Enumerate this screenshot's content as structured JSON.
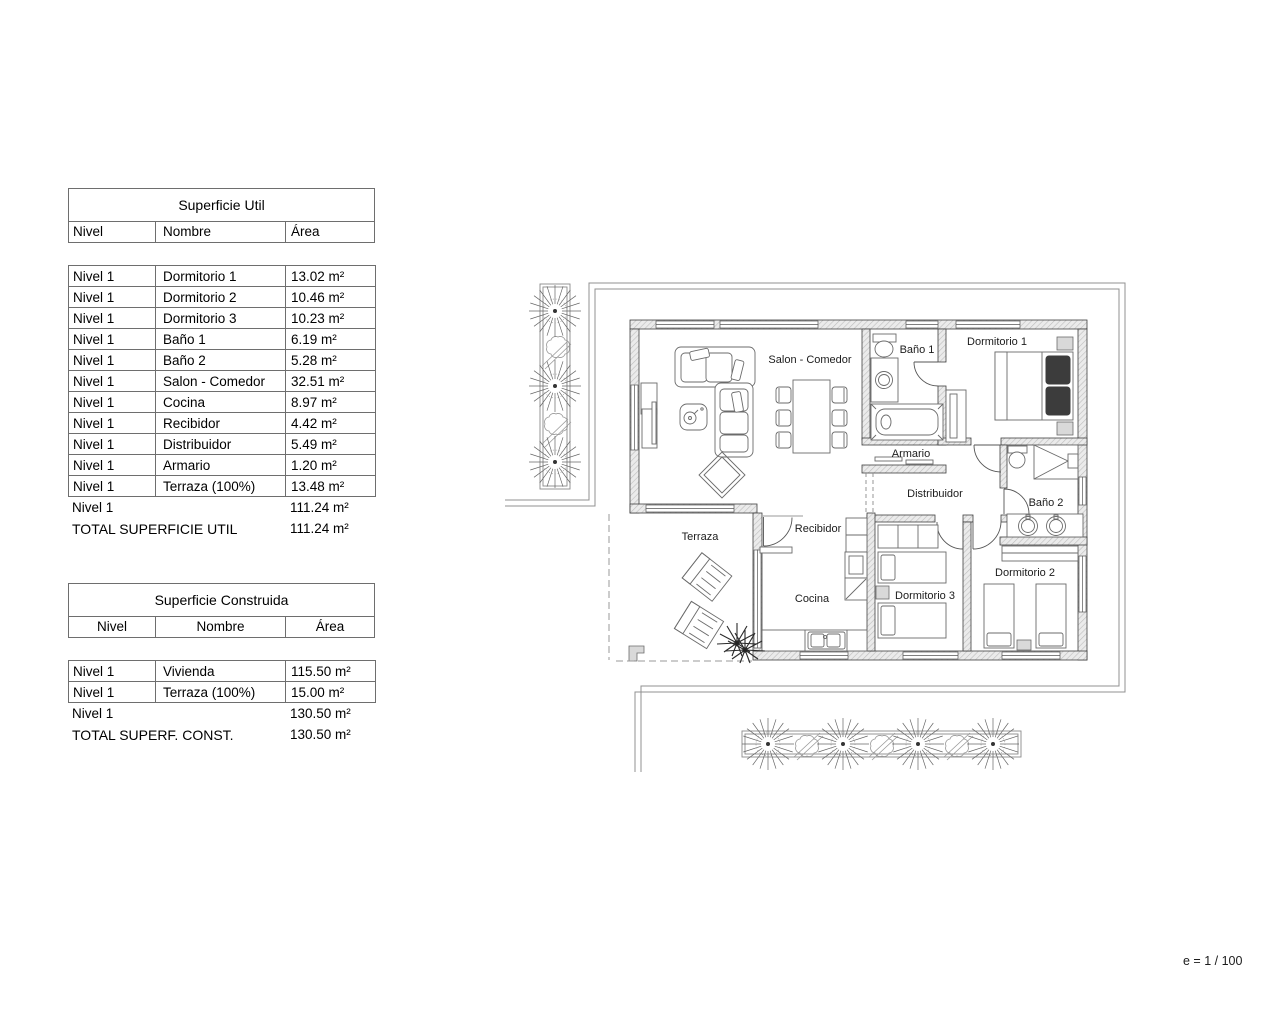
{
  "tables": {
    "superficie_util": {
      "title": "Superficie Util",
      "columns": [
        "Nivel",
        "Nombre",
        "Área"
      ],
      "rows": [
        [
          "Nivel 1",
          "Dormitorio 1",
          "13.02 m²"
        ],
        [
          "Nivel 1",
          "Dormitorio 2",
          "10.46 m²"
        ],
        [
          "Nivel 1",
          "Dormitorio 3",
          "10.23 m²"
        ],
        [
          "Nivel 1",
          "Baño 1",
          "6.19 m²"
        ],
        [
          "Nivel 1",
          "Baño 2",
          "5.28 m²"
        ],
        [
          "Nivel 1",
          "Salon - Comedor",
          "32.51 m²"
        ],
        [
          "Nivel 1",
          "Cocina",
          "8.97 m²"
        ],
        [
          "Nivel 1",
          "Recibidor",
          "4.42 m²"
        ],
        [
          "Nivel 1",
          "Distribuidor",
          "5.49 m²"
        ],
        [
          "Nivel 1",
          "Armario",
          "1.20 m²"
        ],
        [
          "Nivel 1",
          "Terraza (100%)",
          "13.48 m²"
        ]
      ],
      "subtotal": {
        "label": "Nivel 1",
        "value": "111.24 m²"
      },
      "total": {
        "label": "TOTAL SUPERFICIE UTIL",
        "value": "111.24 m²"
      }
    },
    "superficie_construida": {
      "title": "Superficie Construida",
      "columns": [
        "Nivel",
        "Nombre",
        "Área"
      ],
      "rows": [
        [
          "Nivel 1",
          "Vivienda",
          "115.50 m²"
        ],
        [
          "Nivel 1",
          "Terraza (100%)",
          "15.00 m²"
        ]
      ],
      "subtotal": {
        "label": "Nivel 1",
        "value": "130.50 m²"
      },
      "total": {
        "label": "TOTAL SUPERF. CONST.",
        "value": "130.50 m²"
      }
    }
  },
  "plan": {
    "labels": {
      "salon": "Salon - Comedor",
      "bano1": "Baño 1",
      "dormitorio1": "Dormitorio 1",
      "armario": "Armario",
      "distribuidor": "Distribuidor",
      "bano2": "Baño 2",
      "recibidor": "Recibidor",
      "terraza": "Terraza",
      "cocina": "Cocina",
      "dormitorio3": "Dormitorio 3",
      "dormitorio2": "Dormitorio 2"
    },
    "scale_label": "e = 1 / 100"
  },
  "colors": {
    "wall_fill": "#ebebeb",
    "line": "#3f3f3f",
    "boundary": "#909090",
    "table_border": "#6e6e6e",
    "text": "#000000"
  }
}
